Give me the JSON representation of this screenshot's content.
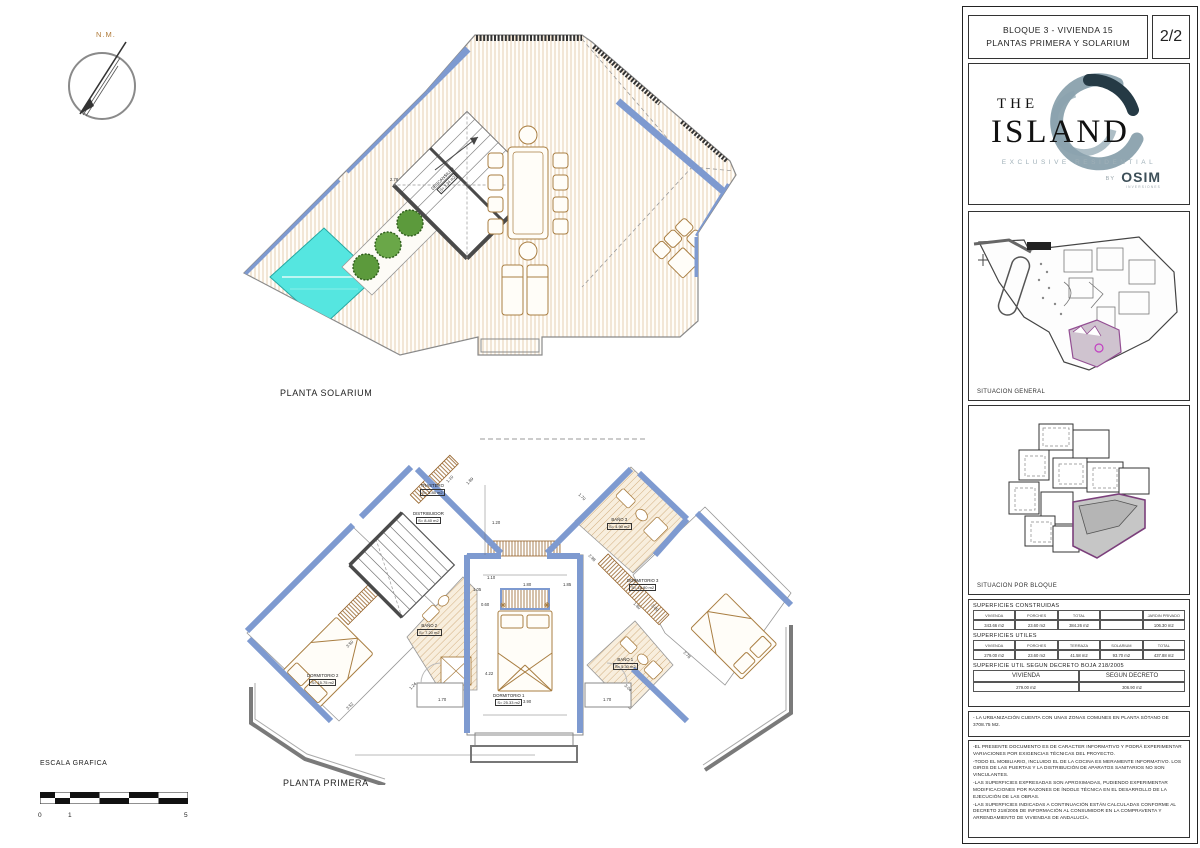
{
  "titleblock": {
    "line1": "BLOQUE 3 - VIVIENDA 15",
    "line2": "PLANTAS PRIMERA Y SOLARIUM",
    "page": "2/2"
  },
  "logo": {
    "the": "THE",
    "island": "ISLAND",
    "subtitle": "EXCLUSIVE RESIDENTIAL",
    "by": "BY",
    "brand": "OSIM",
    "brand_sub": "INVERSIONES"
  },
  "panels": {
    "general_label": "SITUACION GENERAL",
    "bloque_label": "SITUACION POR BLOQUE"
  },
  "tables": {
    "construidas": {
      "title": "SUPERFICIES CONSTRUIDAS",
      "headers": [
        "VIVIENDA",
        "PORCHES",
        "TOTAL",
        "",
        "JARDIN PRIVADO"
      ],
      "values": [
        "343.66 m2",
        "23.60 m2",
        "384.26 m2",
        "",
        "106.30 m2"
      ]
    },
    "utiles": {
      "title": "SUPERFICIES UTILES",
      "headers": [
        "VIVIENDA",
        "PORCHES",
        "TERRAZA",
        "SOLARIUM",
        "TOTAL"
      ],
      "values": [
        "279.00 m2",
        "23.60 m2",
        "41.58 m2",
        "93.70 m2",
        "437.88 m2"
      ]
    },
    "decreto": {
      "title": "SUPERFICIE UTIL SEGUN DECRETO BOJA 218/2005",
      "headers": [
        "VIVIENDA",
        "SEGUN DECRETO"
      ],
      "values": [
        "279.00 m2",
        "306.90 m2"
      ]
    }
  },
  "notes": {
    "note1": "- LA URBANIZACIÓN CUENTA CON UNAS ZONAS COMUNES EN PLANTA SÓTANO DE 3708.75 M2.",
    "n1": "-EL PRESENTE DOCUMENTO ES DE CARACTER INFORMATIVO Y PODRÁ EXPERIMENTAR VARIACIONES POR EXIGENCIAS TÉCNICAS DEL PROYECTO.",
    "n2": "-TODO EL MOBILIARIO, INCLUIDO EL DE LA COCINA ES MERAMENTE INFORMATIVO. LOS GIROS DE LAS PUERTAS Y LA DISTRIBUCIÓN DE APARATOS SANITARIOS NO SON VINCULANTES.",
    "n3": "-LAS SUPERFICIES EXPRESADAS SON APROXIMADAS, PUDIENDO EXPERIMENTAR MODIFICACIONES POR RAZONES DE ÍNDOLE TÉCNICA EN EL DESARROLLO DE LA EJECUCIÓN DE LAS OBRAS.",
    "n4": "-LAS SUPERFICIES INDICADAS A CONTINUACIÓN ESTÁN CALCULADAS CONFORME AL DECRETO 218/2005 DE INFORMACIÓN AL CONSUMIDOR EN LA COMPRAVENTA Y ARRENDAMIENTO DE VIVIENDAS DE ANDALUCÍA."
  },
  "compass": {
    "label": "N.M."
  },
  "escala": {
    "title": "ESCALA GRAFICA",
    "t0": "0",
    "t1": "1",
    "t5": "5"
  },
  "plans": {
    "solarium": {
      "label": "PLANTA SOLARIUM",
      "descansillo_name": "DESCANSILLO",
      "descansillo_area": "S= 3.34 m2",
      "dim_278": "2.78"
    },
    "primera": {
      "label": "PLANTA PRIMERA",
      "rooms": [
        {
          "n": "TRASTERO",
          "a": "S= 3.85 m2"
        },
        {
          "n": "DISTRIBUIDOR",
          "a": "S= 8.40 m2"
        },
        {
          "n": "DORMITORIO 1",
          "a": "S= 25.33 m2"
        },
        {
          "n": "DORMITORIO 2",
          "a": "S= 15.75 m2"
        },
        {
          "n": "DORMITORIO 3",
          "a": "S= 18.80 m2"
        },
        {
          "n": "BAÑO 1",
          "a": "S= 5.30 m2"
        },
        {
          "n": "BAÑO 2",
          "a": "S= 7.20 m2"
        },
        {
          "n": "BAÑO 3",
          "a": "S= 4.90 m2"
        }
      ],
      "dims": [
        "1.20",
        "1.10",
        "1.05",
        "1.80",
        "1.85",
        "0.60",
        "4.22",
        "3.90",
        "1.70",
        "1.24",
        "3.52",
        "3.50",
        "2.98",
        "1.80",
        "2.00",
        "2.78",
        "3.04",
        "1.70",
        "1.70",
        "1.10",
        "1.89"
      ]
    }
  }
}
